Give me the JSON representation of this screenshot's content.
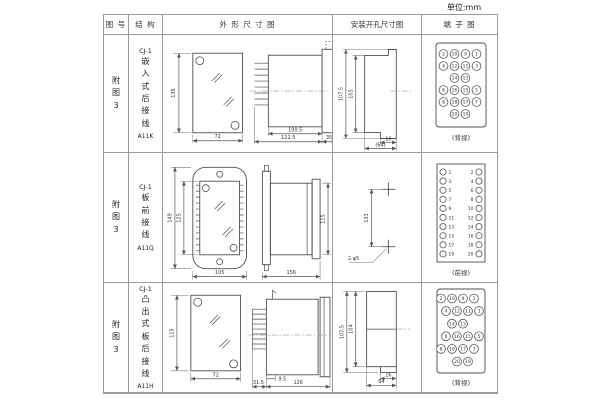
{
  "unit_label": "单位:mm",
  "table": {
    "col_headers": [
      "图 号",
      "结 构",
      "外 形 尺 寸 图",
      "安装开孔尺寸图",
      "端 子 图"
    ]
  },
  "rows": [
    {
      "figure": "附\n图\n3",
      "series": "CJ-1",
      "mount": "嵌\n入\n式\n后\n接\n线",
      "model": "A11K",
      "outline": {
        "height": "135",
        "width": "72",
        "depth": "100.5",
        "depth_total": "122.5",
        "flange": "35"
      },
      "install": {
        "outer": "107.5",
        "inner": "105",
        "tab": "16",
        "width": "(64)"
      },
      "terminal": {
        "view": "(背视)",
        "rows": [
          [
            2,
            10,
            9,
            1
          ],
          [
            4,
            12,
            11,
            3
          ],
          [
            null,
            14,
            13,
            null
          ],
          [
            6,
            16,
            15,
            5
          ],
          [
            8,
            18,
            17,
            7
          ],
          [
            null,
            20,
            19,
            null
          ]
        ]
      }
    },
    {
      "figure": "附\n图\n3",
      "series": "CJ-1",
      "mount": "板\n前\n接\n线",
      "model": "A11Q",
      "outline": {
        "height": "149",
        "inner_height": "125",
        "width": "105",
        "depth": "156",
        "side_height": "115"
      },
      "install": {
        "spacing": "133",
        "holes": "2-φ5"
      },
      "terminal": {
        "view": "(前视)",
        "pairs": [
          [
            1,
            2
          ],
          [
            3,
            4
          ],
          [
            5,
            6
          ],
          [
            7,
            8
          ],
          [
            9,
            10
          ],
          [
            11,
            12
          ],
          [
            13,
            14
          ],
          [
            15,
            16
          ],
          [
            17,
            18
          ],
          [
            19,
            20
          ]
        ]
      }
    },
    {
      "figure": "附\n图\n3",
      "series": "CJ-1",
      "mount": "凸\n出\n式\n板\n后\n接\n线",
      "model": "A11H",
      "outline": {
        "height": "115",
        "width": "72",
        "comb": "31.5",
        "offset": "9.5",
        "depth": "126"
      },
      "install": {
        "outer": "107.5",
        "inner": "104",
        "tab": "16",
        "width": "64"
      },
      "terminal": {
        "view": "(背视)",
        "rows": [
          [
            2,
            10,
            9,
            1
          ],
          [
            4,
            12,
            11,
            3
          ],
          [
            null,
            14,
            13,
            null
          ],
          [
            6,
            16,
            15,
            5
          ],
          [
            8,
            18,
            17,
            7
          ],
          [
            null,
            20,
            19,
            null
          ]
        ]
      }
    }
  ]
}
